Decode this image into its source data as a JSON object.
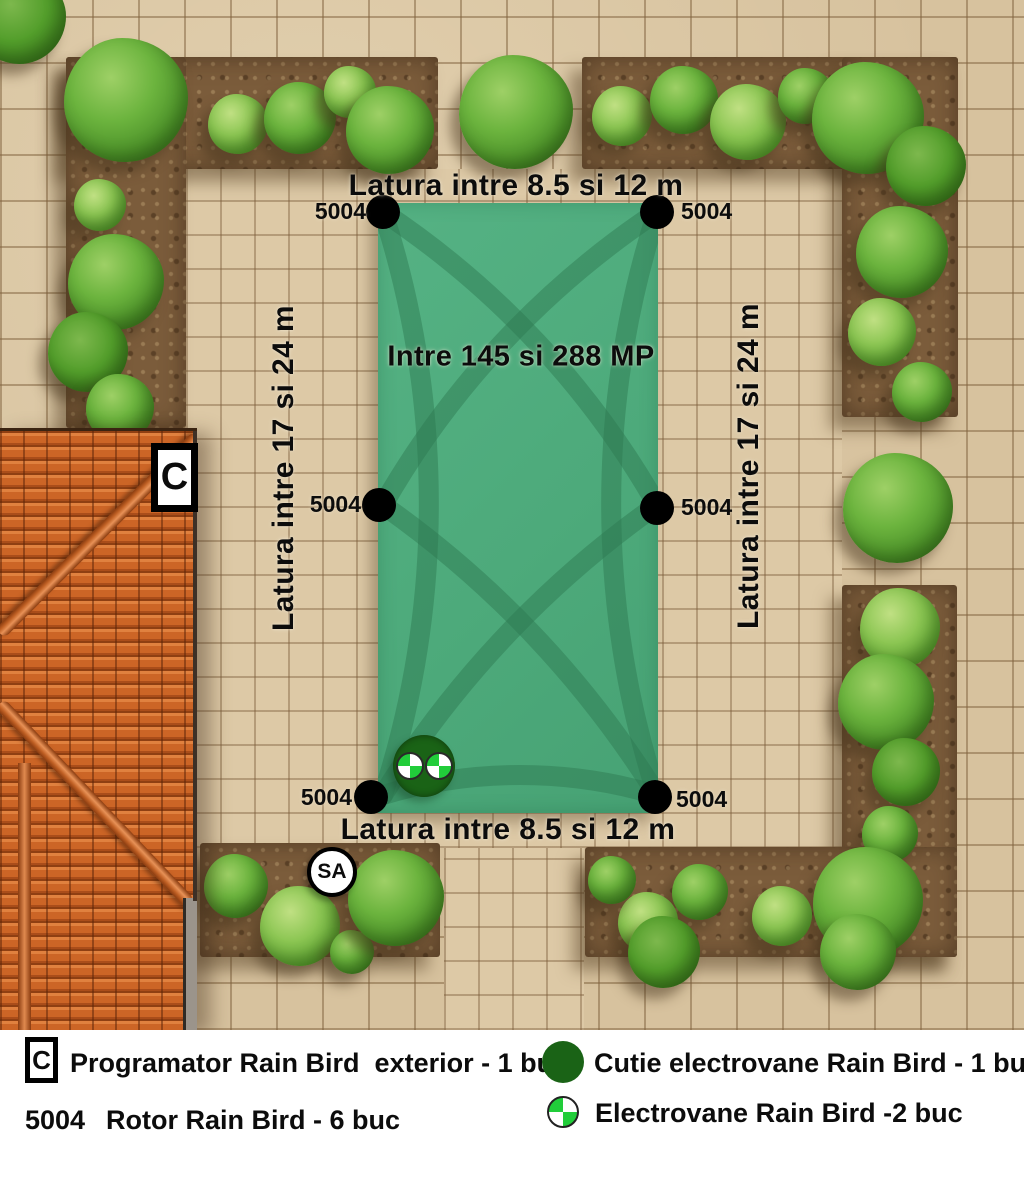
{
  "plan": {
    "labels": {
      "top_side": "Latura intre 8.5 si 12 m",
      "bottom_side": "Latura intre 8.5 si 12 m",
      "left_side": "Latura intre 17 si 24 m",
      "right_side": "Latura intre 17 si 24 m",
      "area": "Intre 145 si 288 MP"
    },
    "rotors": [
      {
        "id": "top-left",
        "label": "5004"
      },
      {
        "id": "top-right",
        "label": "5004"
      },
      {
        "id": "mid-left",
        "label": "5004"
      },
      {
        "id": "mid-right",
        "label": "5004"
      },
      {
        "id": "bottom-left",
        "label": "5004"
      },
      {
        "id": "bottom-right",
        "label": "5004"
      }
    ],
    "controller_marker": {
      "label": "C"
    },
    "sa_marker": {
      "label": "SA"
    }
  },
  "legend": {
    "items": [
      {
        "symbol": "controller-box",
        "symbol_text": "C",
        "label": "Programator Rain Bird  exterior - 1 buc"
      },
      {
        "symbol": "rotor-code",
        "symbol_text": "5004",
        "label": "Rotor Rain Bird - 6 buc"
      },
      {
        "symbol": "valve-box-circle",
        "symbol_text": "",
        "label": "Cutie electrovane Rain Bird - 1 buc"
      },
      {
        "symbol": "electrovalve-circle",
        "symbol_text": "",
        "label": "Electrovane Rain Bird -2 buc"
      }
    ]
  },
  "colors": {
    "lawn_green": "#4daa7b",
    "coverage_arc_green": "#2e7a52",
    "paving_tan": "#d7c29e",
    "soil_brown": "#7b5c3b",
    "bush_green": "#63b23a",
    "roof_terracotta": "#c65f28",
    "valve_box_dark_green": "#1a6316",
    "electrovalve_bright_green": "#21cd3a",
    "marker_black": "#000000"
  }
}
